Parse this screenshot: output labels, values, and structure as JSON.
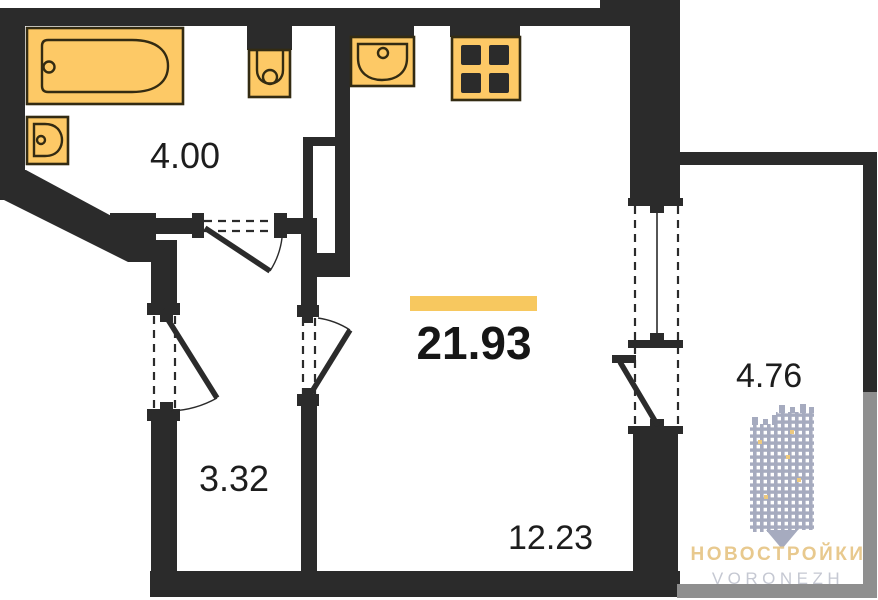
{
  "plan": {
    "rooms": [
      {
        "name": "bathroom",
        "area": "4.00"
      },
      {
        "name": "hallway",
        "area": "3.32"
      },
      {
        "name": "total",
        "area": "21.93",
        "highlighted": true
      },
      {
        "name": "living-zone",
        "area": "12.23"
      },
      {
        "name": "balcony",
        "area": "4.76"
      }
    ],
    "fixtures": [
      "bathtub",
      "bath-sink",
      "toilet",
      "kitchen-sink",
      "stove"
    ]
  },
  "watermark": {
    "brand": "НОВОСТРОЙКИ",
    "city": "VORONEZH"
  },
  "colors": {
    "accent": "#F7C85F",
    "wall": "#2B2B2B",
    "fixture-fill": "#FDC966",
    "fixture-stroke": "#332B12",
    "gray-wall": "#8F8F8F",
    "wm-building": "#A6ABBF",
    "wm-brand": "#E8C98E",
    "wm-city": "#C5C8D2"
  }
}
